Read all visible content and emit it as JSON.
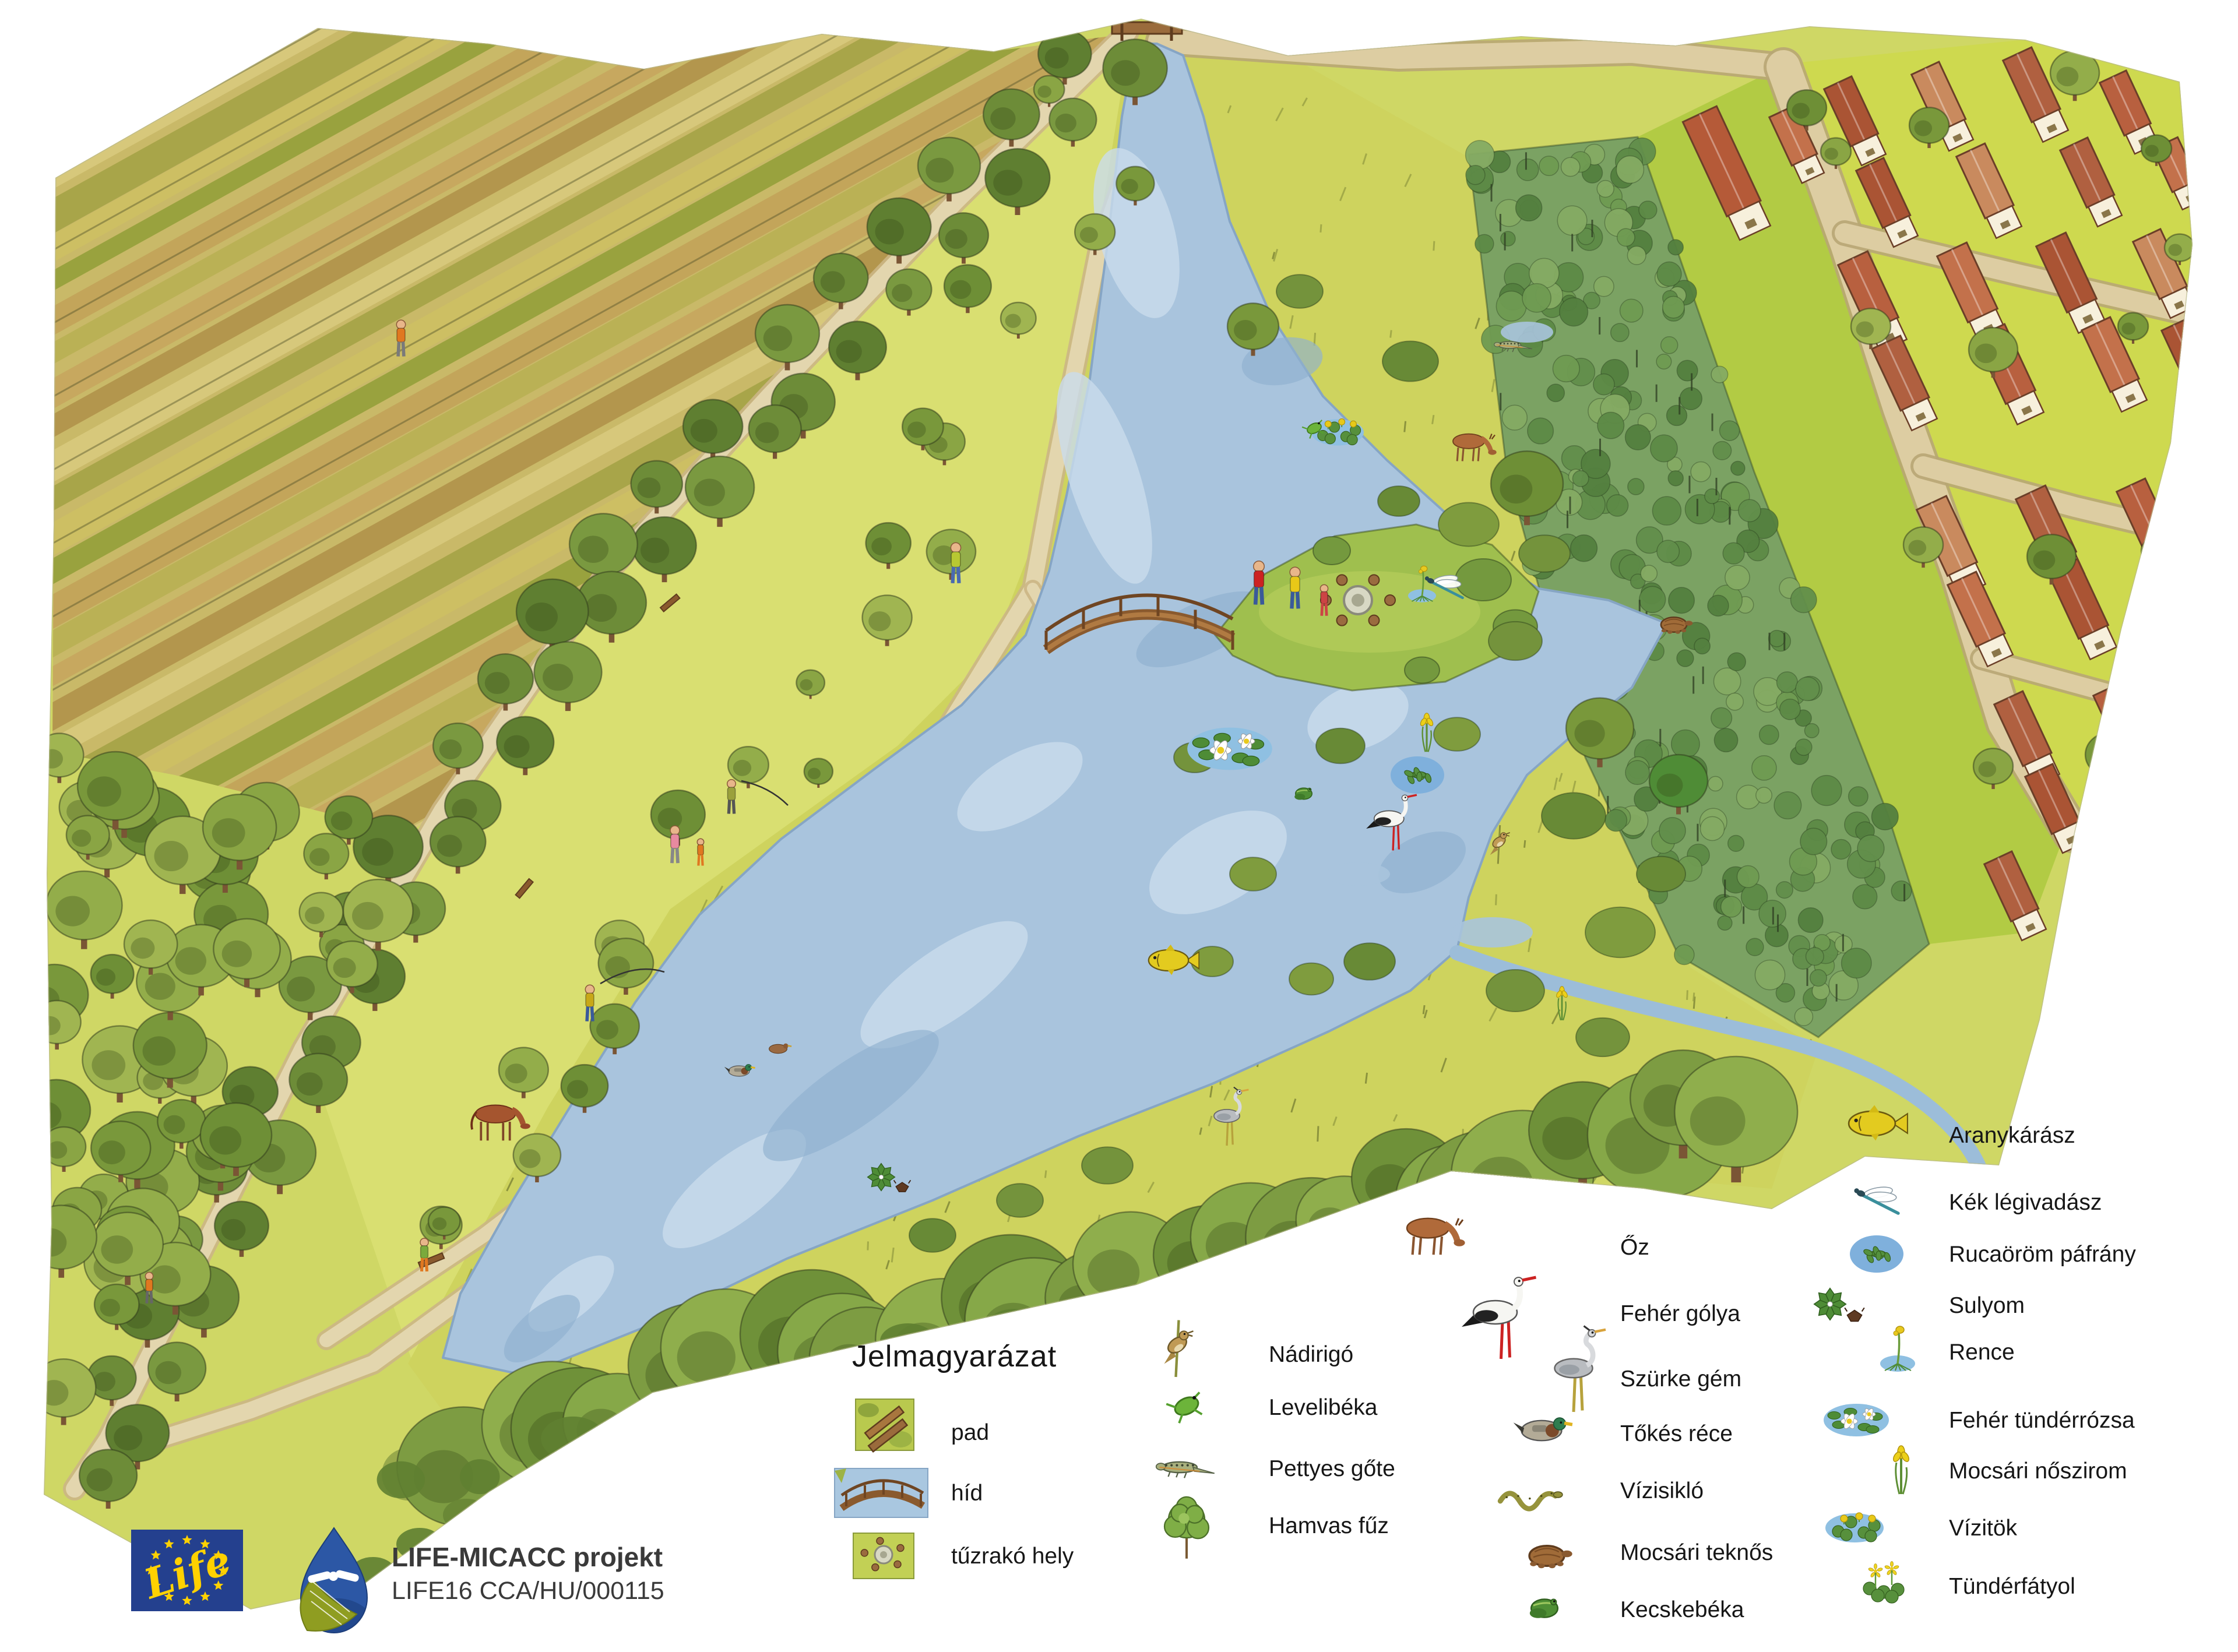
{
  "legend": {
    "title": "Jelmagyarázat",
    "facilities": [
      {
        "label": "pad",
        "icon": "bench-icon"
      },
      {
        "label": "híd",
        "icon": "bridge-icon"
      },
      {
        "label": "tűzrakó hely",
        "icon": "fire-pit-icon"
      }
    ],
    "species_col_a": [
      {
        "label": "Nádirigó",
        "icon": "reed-warbler-icon"
      },
      {
        "label": "Levelibéka",
        "icon": "tree-frog-icon"
      },
      {
        "label": "Pettyes gőte",
        "icon": "spotted-newt-icon"
      },
      {
        "label": "Hamvas fűz",
        "icon": "grey-willow-icon"
      }
    ],
    "species_col_b": [
      {
        "label": "Őz",
        "icon": "roe-deer-icon"
      },
      {
        "label": "Fehér gólya",
        "icon": "white-stork-icon"
      },
      {
        "label": "Szürke gém",
        "icon": "grey-heron-icon"
      },
      {
        "label": "Tőkés réce",
        "icon": "mallard-icon"
      },
      {
        "label": "Vízisikló",
        "icon": "grass-snake-icon"
      },
      {
        "label": "Mocsári teknős",
        "icon": "pond-turtle-icon"
      },
      {
        "label": "Kecskebéka",
        "icon": "edible-frog-icon"
      }
    ],
    "species_col_c": [
      {
        "label": "Aranykárász",
        "icon": "crucian-carp-icon"
      },
      {
        "label": "Kék légivadász",
        "icon": "damselfly-icon"
      },
      {
        "label": "Rucaöröm páfrány",
        "icon": "water-fern-icon"
      },
      {
        "label": "Sulyom",
        "icon": "water-chestnut-icon"
      },
      {
        "label": "Rence",
        "icon": "bladderwort-icon"
      },
      {
        "label": "Fehér tündérrózsa",
        "icon": "white-water-lily-icon"
      },
      {
        "label": "Mocsári nőszirom",
        "icon": "yellow-iris-icon"
      },
      {
        "label": "Vízitök",
        "icon": "yellow-pond-lily-icon"
      },
      {
        "label": "Tündérfátyol",
        "icon": "fringed-water-lily-icon"
      }
    ]
  },
  "project": {
    "name": "LIFE-MICACC projekt",
    "code": "LIFE16 CCA/HU/000115",
    "eu_logo_word": "Life"
  },
  "colors": {
    "eu_blue": "#24408e",
    "eu_yellow": "#ffd100",
    "logo_drop_blue": "#2c57a5",
    "logo_leaf": "#8f9d21",
    "water": "#a9c4dd",
    "water_light": "#c9dcec",
    "water_deep": "#8fb0cf",
    "meadow": "#d9df72",
    "reed_marsh": "#ced35e",
    "field_tan": "#c5a55e",
    "plantation_green": "#7ba263",
    "grass_strip": "#b2cb44",
    "village_green": "#ced94f",
    "road": "#ddcda2",
    "path": "#e3d6ae",
    "roof_red": "#b8603f",
    "tree_green": "#79983b",
    "ink": "#2f3b16"
  }
}
